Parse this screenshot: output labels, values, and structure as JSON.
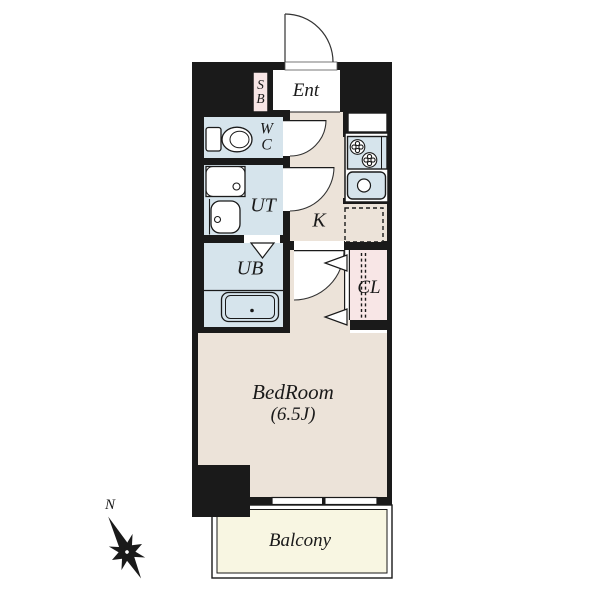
{
  "plan": {
    "type": "apartment-floor-plan",
    "rooms": {
      "shoe_box": "S\nB",
      "entrance": "Ent",
      "toilet": "W\nC",
      "utility": "UT",
      "bath": "UB",
      "kitchen": "K",
      "closet": "CL",
      "bedroom": "BedRoom",
      "bedroom_size": "(6.5J)",
      "balcony": "Balcony"
    },
    "compass": {
      "north": "N"
    },
    "colors": {
      "wall": "#1a1a1a",
      "floor": "#ece3d9",
      "wet_area": "#d6e4ec",
      "storage": "#f8e6e6",
      "balcony": "#f8f6e2",
      "background": "#ffffff"
    }
  }
}
